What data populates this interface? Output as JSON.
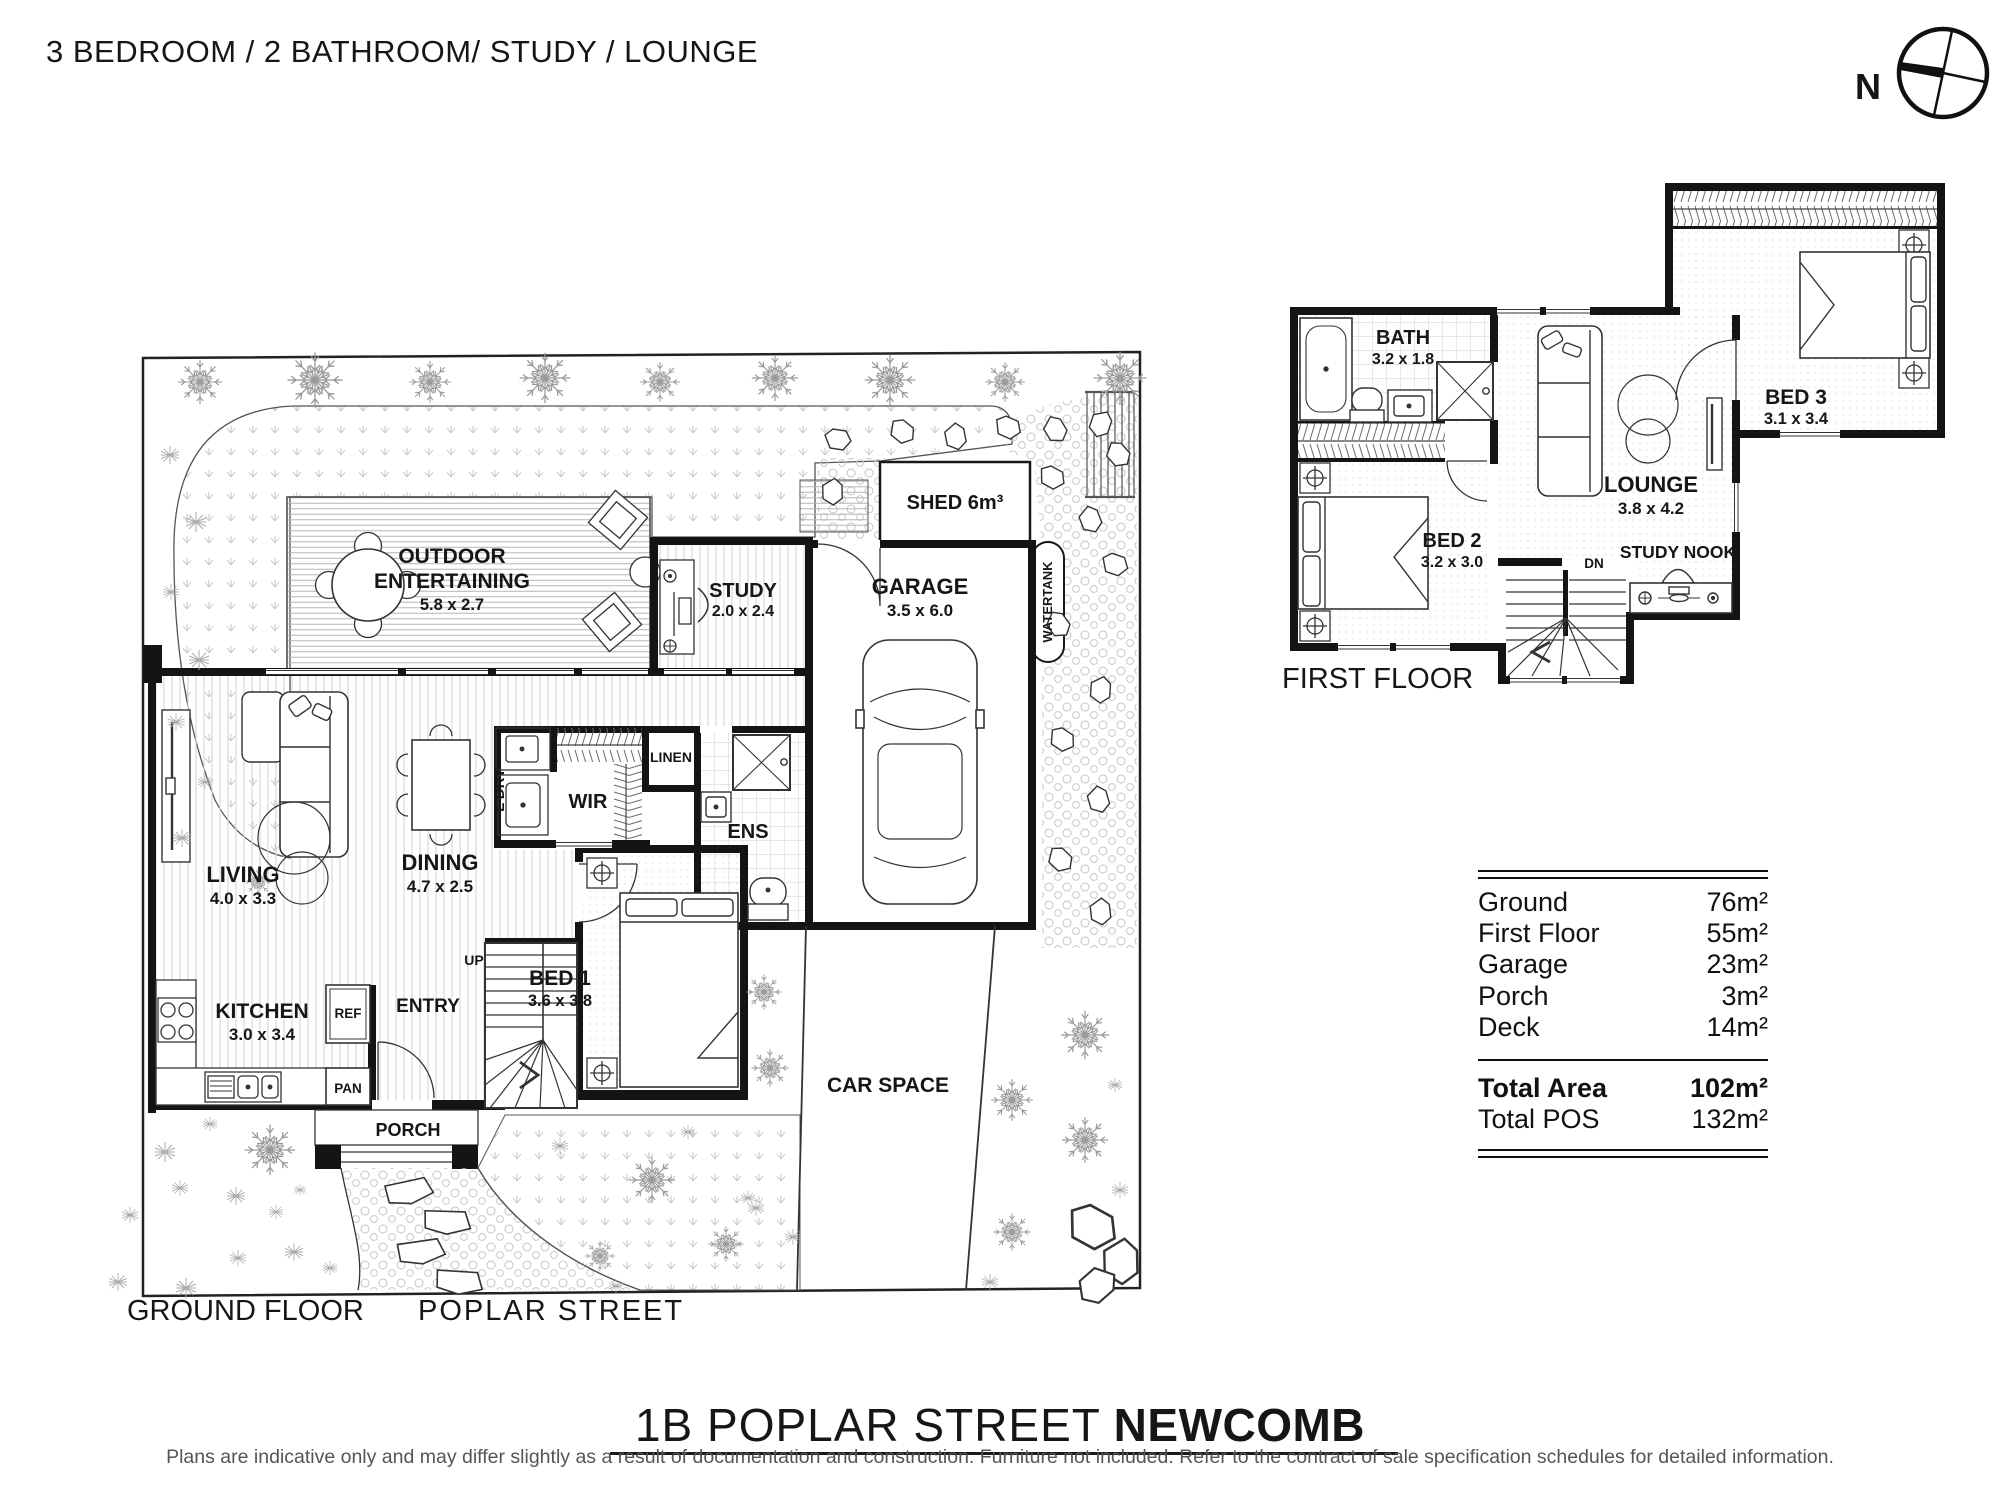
{
  "title": "3 BEDROOM / 2 BATHROOM/ STUDY / LOUNGE",
  "compass": {
    "label": "N"
  },
  "ground_floor": {
    "floor_label": "GROUND FLOOR",
    "street_label": "POPLAR STREET",
    "rooms": {
      "outdoor": {
        "line1": "OUTDOOR",
        "line2": "ENTERTAINING",
        "dims": "5.8 x 2.7"
      },
      "study": {
        "name": "STUDY",
        "dims": "2.0 x 2.4"
      },
      "shed": {
        "name": "SHED 6m³"
      },
      "garage": {
        "name": "GARAGE",
        "dims": "3.5 x 6.0"
      },
      "watertank": {
        "name": "WATERTANK"
      },
      "living": {
        "name": "LIVING",
        "dims": "4.0 x 3.3"
      },
      "dining": {
        "name": "DINING",
        "dims": "4.7 x 2.5"
      },
      "ldry": {
        "name": "L'DRY"
      },
      "wir": {
        "name": "WIR"
      },
      "linen": {
        "name": "LINEN"
      },
      "ens": {
        "name": "ENS"
      },
      "kitchen": {
        "name": "KITCHEN",
        "dims": "3.0 x 3.4"
      },
      "ref": {
        "name": "REF"
      },
      "pan": {
        "name": "PAN"
      },
      "entry": {
        "name": "ENTRY"
      },
      "up": {
        "name": "UP"
      },
      "bed1": {
        "name": "BED 1",
        "dims": "3.6 x 3.8"
      },
      "porch": {
        "name": "PORCH"
      },
      "carspace": {
        "name": "CAR SPACE"
      }
    }
  },
  "first_floor": {
    "floor_label": "FIRST FLOOR",
    "rooms": {
      "bath": {
        "name": "BATH",
        "dims": "3.2 x 1.8"
      },
      "bed2": {
        "name": "BED 2",
        "dims": "3.2 x 3.0"
      },
      "lounge": {
        "name": "LOUNGE",
        "dims": "3.8 x 4.2"
      },
      "bed3": {
        "name": "BED 3",
        "dims": "3.1 x 3.4"
      },
      "study_nook": {
        "name": "STUDY NOOK"
      },
      "dn": {
        "name": "DN"
      }
    }
  },
  "area_table": {
    "rows": [
      {
        "label": "Ground",
        "value": "76m²"
      },
      {
        "label": "First Floor",
        "value": "55m²"
      },
      {
        "label": "Garage",
        "value": "23m²"
      },
      {
        "label": "Porch",
        "value": "3m²"
      },
      {
        "label": "Deck",
        "value": "14m²"
      }
    ],
    "totals": [
      {
        "label": "Total Area",
        "value": "102m²"
      },
      {
        "label": "Total POS",
        "value": "132m²"
      }
    ]
  },
  "footer": {
    "address_main": "1B POPLAR STREET",
    "address_suburb": "NEWCOMB",
    "disclaimer": "Plans are indicative only and may differ slightly as a result of documentation and construction.  Furniture not included. Refer to the contract of sale specification schedules for detailed information."
  }
}
